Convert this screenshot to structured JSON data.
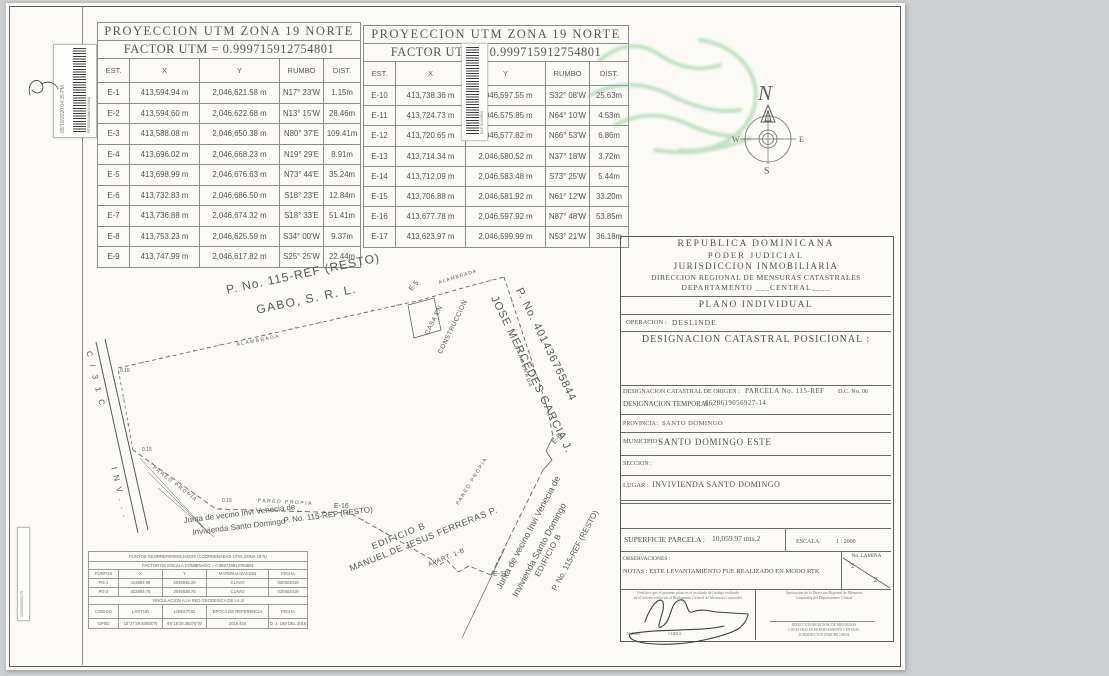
{
  "colors": {
    "paper": "#fbfaf6",
    "ink": "#4a4a4a",
    "watermark_green": "#86c98a"
  },
  "stickers": {
    "top_left": {
      "timestamp": "05/10/2020 04:35 PM",
      "code": "FE0525A8MDH29AA"
    },
    "bottom_left": {
      "code": "4250000000175"
    }
  },
  "utm_table_1": {
    "title": "PROYECCION UTM ZONA 19 NORTE",
    "factor_label": "FACTOR UTM =",
    "factor_value": "0.999715912754801",
    "headers": [
      "EST.",
      "X",
      "Y",
      "RUMBO",
      "DIST."
    ],
    "rows": [
      [
        "E-1",
        "413,594.94 m",
        "2,046,621.58 m",
        "N17° 23'W",
        "1.15m"
      ],
      [
        "E-2",
        "413,594.60 m",
        "2,046,622.68 m",
        "N13° 15'W",
        "28.46m"
      ],
      [
        "E-3",
        "413,588.08 m",
        "2,046,650.38 m",
        "N80° 37'E",
        "109.41m"
      ],
      [
        "E-4",
        "413,696.02 m",
        "2,046,668.23 m",
        "N19° 29'E",
        "8.91m"
      ],
      [
        "E-5",
        "413,698.99 m",
        "2,046,676.63 m",
        "N73° 44'E",
        "35.24m"
      ],
      [
        "E-6",
        "413,732.83 m",
        "2,046,686.50 m",
        "S18° 23'E",
        "12.84m"
      ],
      [
        "E-7",
        "413,736.88 m",
        "2,046,674.32 m",
        "S18° 33'E",
        "51.41m"
      ],
      [
        "E-8",
        "413,753.23 m",
        "2,046,625.59 m",
        "S34° 00'W",
        "9.37m"
      ],
      [
        "E-9",
        "413,747.99 m",
        "2,046,617.82 m",
        "S25° 25'W",
        "22.44m"
      ]
    ]
  },
  "utm_table_2": {
    "title": "PROYECCION UTM ZONA 19 NORTE",
    "factor_label": "FACTOR UTM =",
    "factor_value": "0.999715912754801",
    "headers": [
      "EST.",
      "X",
      "Y",
      "RUMBO",
      "DIST."
    ],
    "rows": [
      [
        "E-10",
        "413,738.36 m",
        "2,046,597.55 m",
        "S32° 08'W",
        "25.63m"
      ],
      [
        "E-11",
        "413,724.73 m",
        "2,046,575.85 m",
        "N64° 10'W",
        "4.53m"
      ],
      [
        "E-12",
        "413,720.65 m",
        "2,046,577.82 m",
        "N66° 53'W",
        "6.86m"
      ],
      [
        "E-13",
        "413,714.34 m",
        "2,046,580.52 m",
        "N37° 18'W",
        "3.72m"
      ],
      [
        "E-14",
        "413,712.09 m",
        "2,046,583.48 m",
        "S73° 25'W",
        "5.44m"
      ],
      [
        "E-15",
        "413,706.88 m",
        "2,046,581.92 m",
        "N61° 12'W",
        "33.20m"
      ],
      [
        "E-16",
        "413,677.78 m",
        "2,046,597.92 m",
        "N87° 48'W",
        "53.85m"
      ],
      [
        "E-17",
        "413,623.97 m",
        "2,046,599.99 m",
        "N53° 21'W",
        "36.18m"
      ]
    ]
  },
  "compass": {
    "n": "N",
    "s": "S",
    "e": "E",
    "w": "W"
  },
  "title_block": {
    "line1": "REPUBLICA DOMINICANA",
    "line2": "PODER  JUDICIAL",
    "line3": "JURISDICCION INMOBILIARIA",
    "line4": "DIRECCION REGIONAL DE MENSURAS CATASTRALES",
    "line5": "DEPARTAMENTO ___CENTRAL____",
    "plano": "PLANO INDIVIDUAL",
    "operacion_label": "OPERACION :",
    "operacion_value": "DESLINDE",
    "designacion_posicional": "DESIGNACION CATASTRAL POSICIONAL :",
    "origen_label": "DESIGNACION CATASTRAL DE ORIGEN :",
    "origen_value": "PARCELA No. 115-REF",
    "origen_dc": "D.C. No. 06",
    "temporal_label": "DESIGNACION TEMPORAL :",
    "temporal_value": "6628619056927-14",
    "provincia_label": "PROVINCIA :",
    "provincia_value": "SANTO DOMINGO",
    "municipio_label": "MUNICIPIO :",
    "municipio_value": "SANTO DOMINGO ESTE",
    "seccion_label": "SECCION :",
    "lugar_label": "LUGAR :",
    "lugar_value": "INVIVIENDA SANTO DOMINGO",
    "superficie_label": "SUPERFICIE PARCELA :",
    "superficie_value": "10,059.97 mts.2",
    "escala_label": "ESCALA",
    "escala_value": "1 : 2000",
    "observaciones": "OBSERVACIONES :",
    "notas": "NOTAS : ESTE LEVANTAMIENTO FUE REALIZADO EN MODO RTK",
    "lamina_label": "No. LAMINA",
    "lamina_top": "2",
    "lamina_bottom": "2",
    "cert_left_line1": "Certifico: que el presente plano es el resultado del trabajo realizado",
    "cert_left_line2": "en el terreno conforme al Reglamento General de Mensuras Catastrales",
    "cert_left_sign": "AGRIM.                          CODIA",
    "cert_right_line1": "Aprobacion de la Direccion Regional de Mensuras",
    "cert_right_line2": "Catastrales del Departamento Central",
    "cert_right_b1": "DIRECCION REGIONAL DE MENSURAS",
    "cert_right_b2": "CATASTRALES  DEPARTAMENTO CENTRAL",
    "cert_right_b3": "JURISDICCION INMOBILIARIA"
  },
  "georef_table": {
    "title": "PUNTOS GEORREFERENCIADOS (COORDENADAS UTM, ZONA 19 N)",
    "factor": "FACTOR DE ESCALA COMBINADO =      0.999715912754801",
    "headers": [
      "PUNTOS",
      "X",
      "Y",
      "MATERIALIZACION",
      "FECHA"
    ],
    "rows": [
      [
        "PG-1",
        "413594.06",
        "2046915.28",
        "CLAVO",
        "03/06/2019"
      ],
      [
        "PG-2",
        "413594.76",
        "2046836.76",
        "CLAVO",
        "03/06/2019"
      ]
    ],
    "vinc_title": "VINCULACION A LA RED GEODESICA DE LA JI",
    "headers2": [
      "CODIGO",
      "LATITUD",
      "LONGITUD",
      "EPOCA DE REFERENCIA",
      "FECHA"
    ],
    "rows2": [
      [
        "GPSD",
        "18°27'29.63005\"N",
        "69°18'20.36375\"W",
        "2016.434",
        "D. J. 198 DEL 2016"
      ]
    ]
  },
  "map": {
    "labels": [
      {
        "t": "P.  No. 115-REF (RESTO)",
        "x": 225,
        "y": 283,
        "r": -12,
        "s": 12,
        "ls": 1
      },
      {
        "t": "GABO, S. R. L.",
        "x": 255,
        "y": 303,
        "r": -12,
        "s": 12,
        "ls": 1.5
      },
      {
        "t": "ALAMBRADA",
        "x": 236,
        "y": 342,
        "r": -11,
        "s": 5,
        "ls": 1.5
      },
      {
        "t": "ALAMBRADA",
        "x": 438,
        "y": 280,
        "r": -17,
        "s": 5,
        "ls": 1
      },
      {
        "t": "ALAMBRADA",
        "x": 519,
        "y": 345,
        "r": 71,
        "s": 5,
        "ls": 1.5
      },
      {
        "t": "CASA EN",
        "x": 424,
        "y": 333,
        "r": -64,
        "s": 6.5,
        "ls": 0.5
      },
      {
        "t": "CONSTRUCCION",
        "x": 437,
        "y": 352,
        "r": -64,
        "s": 6.5,
        "ls": 0.5
      },
      {
        "t": "E-5",
        "x": 408,
        "y": 288,
        "r": -50,
        "s": 7,
        "ls": 0
      },
      {
        "t": "E-8",
        "x": 551,
        "y": 441,
        "r": -50,
        "s": 7,
        "ls": 0
      },
      {
        "t": "P.  No. 401436765844",
        "x": 524,
        "y": 286,
        "r": 64,
        "s": 11,
        "ls": 1
      },
      {
        "t": "JOSE MERCEDES GARCIA J.",
        "x": 499,
        "y": 294,
        "r": 64,
        "s": 11,
        "ls": 1
      },
      {
        "t": "E-16",
        "x": 334,
        "y": 503,
        "r": 0,
        "s": 7,
        "ls": 0
      },
      {
        "t": "E-11",
        "x": 493,
        "y": 571,
        "r": 0,
        "s": 7,
        "ls": 0
      },
      {
        "t": "PARED PROPIA",
        "x": 155,
        "y": 465,
        "r": 38,
        "s": 5,
        "ls": 1.5
      },
      {
        "t": "PARED PROPIA",
        "x": 258,
        "y": 498,
        "r": 3,
        "s": 5,
        "ls": 1.5
      },
      {
        "t": "PARED PROPIA",
        "x": 455,
        "y": 503,
        "r": -58,
        "s": 5,
        "ls": 1.5
      },
      {
        "t": "0.15",
        "x": 120,
        "y": 368,
        "r": 0,
        "s": 5,
        "ls": 0
      },
      {
        "t": "0.15",
        "x": 142,
        "y": 447,
        "r": 0,
        "s": 5,
        "ls": 0
      },
      {
        "t": "0.15",
        "x": 222,
        "y": 498,
        "r": 0,
        "s": 5,
        "ls": 0
      },
      {
        "t": "Junta de vecino Invi Venecia de",
        "x": 183,
        "y": 516,
        "r": -7,
        "s": 8,
        "ls": 0
      },
      {
        "t": "Invivienda Santo Domingo",
        "x": 192,
        "y": 528,
        "r": -7,
        "s": 8,
        "ls": 0
      },
      {
        "t": "P.  No. 115-REF (RESTO)",
        "x": 283,
        "y": 516,
        "r": -7,
        "s": 8,
        "ls": 0
      },
      {
        "t": "EDIFICIO B",
        "x": 370,
        "y": 542,
        "r": -22,
        "s": 9,
        "ls": 1
      },
      {
        "t": "APART. 1-B",
        "x": 427,
        "y": 562,
        "r": -22,
        "s": 6.5,
        "ls": 0.5
      },
      {
        "t": "MANUEL DE JESUS FERRERAS P.",
        "x": 348,
        "y": 564,
        "r": -22,
        "s": 9,
        "ls": 0.5
      },
      {
        "t": "Junta de vecino Invi Venecia de",
        "x": 494,
        "y": 586,
        "r": -62,
        "s": 9,
        "ls": 0
      },
      {
        "t": "Invivienda Santo Domingo",
        "x": 510,
        "y": 594,
        "r": -62,
        "s": 9,
        "ls": 0
      },
      {
        "t": "EDIFICIO B",
        "x": 533,
        "y": 574,
        "r": -62,
        "s": 8,
        "ls": 0.5
      },
      {
        "t": "P.  No. 115-REF (RESTO)",
        "x": 550,
        "y": 588,
        "r": -62,
        "s": 8,
        "ls": 0
      },
      {
        "t": "C  /  3 1 C",
        "x": 93,
        "y": 350,
        "r": 76,
        "s": 8,
        "ls": 3
      },
      {
        "t": "I N V . . .",
        "x": 118,
        "y": 466,
        "r": 76,
        "s": 8,
        "ls": 2
      }
    ],
    "lines": [
      {
        "n": "road-edge-left",
        "pts": [
          [
            96,
            342
          ],
          [
            138,
            533
          ]
        ],
        "w": 1,
        "dash": null,
        "ticks": false
      },
      {
        "n": "road-edge-right",
        "pts": [
          [
            105,
            339
          ],
          [
            148,
            530
          ]
        ],
        "w": 1,
        "dash": null,
        "ticks": false
      },
      {
        "n": "fence-north",
        "pts": [
          [
            118,
            368
          ],
          [
            421,
            300
          ],
          [
            466,
            287
          ],
          [
            504,
            277
          ]
        ],
        "w": 0.8,
        "dash": "4 3",
        "ticks": true
      },
      {
        "n": "fence-east",
        "pts": [
          [
            504,
            277
          ],
          [
            548,
            410
          ],
          [
            553,
            437
          ]
        ],
        "w": 0.8,
        "dash": "4 3",
        "ticks": true
      },
      {
        "n": "corner-east",
        "pts": [
          [
            553,
            437
          ],
          [
            546,
            451
          ],
          [
            552,
            460
          ],
          [
            543,
            470
          ]
        ],
        "w": 0.8,
        "dash": null,
        "ticks": false
      },
      {
        "n": "wall-southeast",
        "pts": [
          [
            543,
            470
          ],
          [
            491,
            575
          ]
        ],
        "w": 0.8,
        "dash": "5 3",
        "ticks": true
      },
      {
        "n": "wall-south",
        "pts": [
          [
            491,
            575
          ],
          [
            469,
            566
          ],
          [
            458,
            572
          ],
          [
            447,
            560
          ],
          [
            438,
            566
          ],
          [
            431,
            559
          ],
          [
            350,
            513
          ]
        ],
        "w": 0.8,
        "dash": "5 3",
        "ticks": true
      },
      {
        "n": "wall-southwest",
        "pts": [
          [
            350,
            513
          ],
          [
            216,
            509
          ],
          [
            133,
            450
          ]
        ],
        "w": 0.8,
        "dash": "5 3",
        "ticks": true
      },
      {
        "n": "edge-west",
        "pts": [
          [
            133,
            450
          ],
          [
            118,
            368
          ]
        ],
        "w": 0.7,
        "dash": "3 3",
        "ticks": true
      },
      {
        "n": "casa-outline",
        "pts": [
          [
            408,
            305
          ],
          [
            434,
            298
          ],
          [
            441,
            330
          ],
          [
            414,
            338
          ],
          [
            408,
            305
          ]
        ],
        "w": 0.7,
        "dash": null,
        "ticks": false
      },
      {
        "n": "e11-extension",
        "pts": [
          [
            505,
            548
          ],
          [
            462,
            638
          ]
        ],
        "w": 0.6,
        "dash": null,
        "ticks": false
      },
      {
        "n": "leader-1",
        "pts": [
          [
            140,
            458
          ],
          [
            207,
            531
          ]
        ],
        "w": 0.5,
        "dash": null,
        "ticks": false
      },
      {
        "n": "leader-2",
        "pts": [
          [
            148,
            472
          ],
          [
            210,
            534
          ]
        ],
        "w": 0.5,
        "dash": null,
        "ticks": false
      },
      {
        "n": "leader-3",
        "pts": [
          [
            158,
            488
          ],
          [
            214,
            537
          ]
        ],
        "w": 0.5,
        "dash": null,
        "ticks": false
      }
    ]
  }
}
